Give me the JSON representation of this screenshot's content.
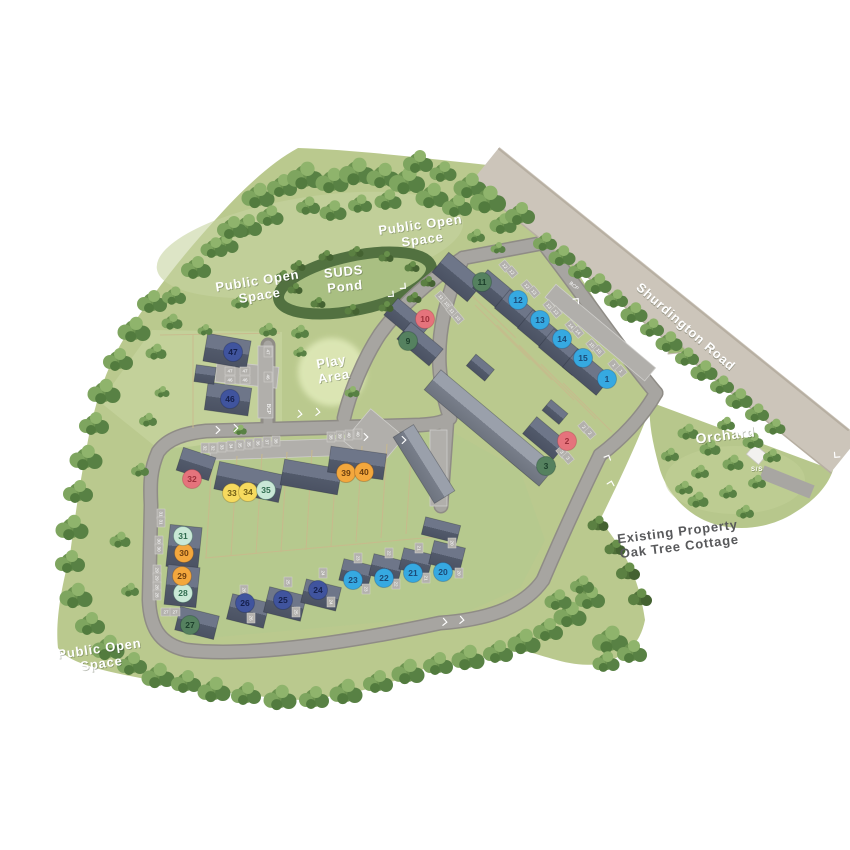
{
  "map": {
    "title": "Development site plan",
    "labels": [
      {
        "id": "public-open-space-top",
        "text": "Public Open\nSpace",
        "x": 421,
        "y": 229,
        "color": "#ffffff",
        "size": 13,
        "rotate": -8
      },
      {
        "id": "suds-pond",
        "text": "SUDS\nPond",
        "x": 344,
        "y": 276,
        "color": "#ffffff",
        "size": 13,
        "rotate": -6
      },
      {
        "id": "public-open-space-left",
        "text": "Public Open\nSpace",
        "x": 258,
        "y": 285,
        "color": "#ffffff",
        "size": 13,
        "rotate": -9
      },
      {
        "id": "play-area",
        "text": "Play\nArea",
        "x": 332,
        "y": 366,
        "color": "#ffffff",
        "size": 13,
        "rotate": -10
      },
      {
        "id": "public-open-space-bottom",
        "text": "Public Open\nSpace",
        "x": 100,
        "y": 653,
        "color": "#ffffff",
        "size": 13,
        "rotate": -8
      },
      {
        "id": "orchard",
        "text": "Orchard",
        "x": 726,
        "y": 440,
        "color": "#ffffff",
        "size": 14,
        "rotate": -7
      },
      {
        "id": "shurdington-road",
        "text": "Shurdington Road",
        "x": 683,
        "y": 330,
        "color": "#ffffff",
        "size": 13,
        "rotate": 41
      },
      {
        "id": "existing-property",
        "text": "Existing Property\nOak Tree Cottage",
        "x": 678,
        "y": 536,
        "color": "#58595b",
        "size": 13,
        "rotate": -7
      },
      {
        "id": "substation",
        "text": "S/S",
        "x": 757,
        "y": 471,
        "color": "#ffffff",
        "size": 6,
        "rotate": 0
      }
    ],
    "marker_styles": {
      "blue": {
        "fill": "#36a9e1",
        "text": "#1c4a77"
      },
      "navy": {
        "fill": "#40549e",
        "text": "#15204d"
      },
      "green": {
        "fill": "#55815f",
        "text": "#1c3f2b"
      },
      "pink": {
        "fill": "#e5737c",
        "text": "#9c2f3a"
      },
      "orange": {
        "fill": "#f3a73d",
        "text": "#6d3f10"
      },
      "yellow": {
        "fill": "#f6da5e",
        "text": "#6d5b14"
      },
      "mint": {
        "fill": "#c9e8d6",
        "text": "#2f6b4e"
      }
    },
    "markers": [
      {
        "plot": "1",
        "x": 607,
        "y": 379,
        "type": "blue"
      },
      {
        "plot": "2",
        "x": 567,
        "y": 441,
        "type": "pink"
      },
      {
        "plot": "3",
        "x": 546,
        "y": 466,
        "type": "green"
      },
      {
        "plot": "9",
        "x": 408,
        "y": 341,
        "type": "green"
      },
      {
        "plot": "10",
        "x": 425,
        "y": 319,
        "type": "pink"
      },
      {
        "plot": "11",
        "x": 482,
        "y": 282,
        "type": "green"
      },
      {
        "plot": "12",
        "x": 518,
        "y": 300,
        "type": "blue"
      },
      {
        "plot": "13",
        "x": 540,
        "y": 320,
        "type": "blue"
      },
      {
        "plot": "14",
        "x": 562,
        "y": 339,
        "type": "blue"
      },
      {
        "plot": "15",
        "x": 583,
        "y": 358,
        "type": "blue"
      },
      {
        "plot": "20",
        "x": 443,
        "y": 572,
        "type": "blue"
      },
      {
        "plot": "21",
        "x": 413,
        "y": 573,
        "type": "blue"
      },
      {
        "plot": "22",
        "x": 384,
        "y": 578,
        "type": "blue"
      },
      {
        "plot": "23",
        "x": 353,
        "y": 580,
        "type": "blue"
      },
      {
        "plot": "24",
        "x": 318,
        "y": 590,
        "type": "navy"
      },
      {
        "plot": "25",
        "x": 283,
        "y": 600,
        "type": "navy"
      },
      {
        "plot": "26",
        "x": 245,
        "y": 603,
        "type": "navy"
      },
      {
        "plot": "27",
        "x": 190,
        "y": 625,
        "type": "green"
      },
      {
        "plot": "28",
        "x": 183,
        "y": 593,
        "type": "mint"
      },
      {
        "plot": "29",
        "x": 182,
        "y": 576,
        "type": "orange"
      },
      {
        "plot": "30",
        "x": 184,
        "y": 553,
        "type": "orange"
      },
      {
        "plot": "31",
        "x": 183,
        "y": 536,
        "type": "mint"
      },
      {
        "plot": "32",
        "x": 192,
        "y": 479,
        "type": "pink"
      },
      {
        "plot": "33",
        "x": 232,
        "y": 493,
        "type": "yellow"
      },
      {
        "plot": "34",
        "x": 248,
        "y": 492,
        "type": "yellow"
      },
      {
        "plot": "35",
        "x": 266,
        "y": 490,
        "type": "mint"
      },
      {
        "plot": "39",
        "x": 346,
        "y": 473,
        "type": "orange"
      },
      {
        "plot": "40",
        "x": 364,
        "y": 472,
        "type": "orange"
      },
      {
        "plot": "46",
        "x": 230,
        "y": 399,
        "type": "navy"
      },
      {
        "plot": "47",
        "x": 233,
        "y": 352,
        "type": "navy"
      }
    ],
    "road_markings": {
      "v_arrows": [
        [
          392,
          295,
          130
        ],
        [
          404,
          287,
          130
        ],
        [
          300,
          414,
          95
        ],
        [
          318,
          412,
          95
        ],
        [
          366,
          437,
          90
        ],
        [
          404,
          440,
          90
        ],
        [
          577,
          300,
          40
        ],
        [
          608,
          457,
          25
        ],
        [
          611,
          483,
          15
        ],
        [
          836,
          456,
          220
        ],
        [
          218,
          430,
          90
        ],
        [
          236,
          428,
          90
        ],
        [
          445,
          622,
          95
        ],
        [
          462,
          620,
          95
        ]
      ],
      "bcp_labels": [
        [
          573,
          287,
          40
        ],
        [
          267,
          409,
          90
        ]
      ],
      "bcp_text": "BCP"
    },
    "bay_labels": [
      [
        505,
        266,
        "12",
        50
      ],
      [
        512,
        272,
        "12",
        50
      ],
      [
        527,
        286,
        "12",
        50
      ],
      [
        534,
        292,
        "13",
        50
      ],
      [
        549,
        306,
        "13",
        50
      ],
      [
        556,
        312,
        "13",
        50
      ],
      [
        571,
        326,
        "14",
        50
      ],
      [
        578,
        332,
        "14",
        50
      ],
      [
        592,
        345,
        "15",
        50
      ],
      [
        599,
        351,
        "15",
        50
      ],
      [
        614,
        365,
        "1",
        50
      ],
      [
        621,
        371,
        "1",
        50
      ],
      [
        441,
        297,
        "11",
        50
      ],
      [
        447,
        304,
        "10",
        50
      ],
      [
        452,
        311,
        "11",
        50
      ],
      [
        458,
        318,
        "10",
        50
      ],
      [
        584,
        427,
        "2",
        50
      ],
      [
        590,
        433,
        "2",
        50
      ],
      [
        562,
        452,
        "3",
        50
      ],
      [
        568,
        458,
        "3",
        50
      ],
      [
        222,
        447,
        "33",
        90
      ],
      [
        231,
        446,
        "34",
        90
      ],
      [
        240,
        445,
        "35",
        90
      ],
      [
        249,
        444,
        "35",
        90
      ],
      [
        258,
        443,
        "36",
        90
      ],
      [
        267,
        442,
        "37",
        90
      ],
      [
        276,
        441,
        "38",
        90
      ],
      [
        331,
        437,
        "38",
        90
      ],
      [
        340,
        436,
        "39",
        90
      ],
      [
        349,
        435,
        "40",
        90
      ],
      [
        358,
        434,
        "40",
        90
      ],
      [
        161,
        514,
        "31",
        90
      ],
      [
        161,
        522,
        "31",
        90
      ],
      [
        159,
        541,
        "30",
        90
      ],
      [
        159,
        549,
        "30",
        90
      ],
      [
        157,
        570,
        "29",
        90
      ],
      [
        157,
        578,
        "29",
        90
      ],
      [
        157,
        587,
        "28",
        90
      ],
      [
        157,
        595,
        "28",
        90
      ],
      [
        166,
        612,
        "27",
        0
      ],
      [
        175,
        612,
        "27",
        0
      ],
      [
        244,
        590,
        "26",
        90
      ],
      [
        251,
        618,
        "26",
        90
      ],
      [
        288,
        582,
        "25",
        90
      ],
      [
        296,
        612,
        "25",
        90
      ],
      [
        323,
        573,
        "24",
        90
      ],
      [
        331,
        602,
        "24",
        90
      ],
      [
        358,
        558,
        "23",
        90
      ],
      [
        366,
        589,
        "23",
        90
      ],
      [
        389,
        553,
        "22",
        90
      ],
      [
        396,
        584,
        "22",
        90
      ],
      [
        419,
        548,
        "21",
        90
      ],
      [
        426,
        578,
        "21",
        90
      ],
      [
        452,
        543,
        "20",
        90
      ],
      [
        459,
        573,
        "20",
        90
      ],
      [
        205,
        448,
        "32",
        90
      ],
      [
        213,
        448,
        "32",
        90
      ],
      [
        230,
        371,
        "47",
        0
      ],
      [
        245,
        371,
        "47",
        0
      ],
      [
        230,
        380,
        "46",
        0
      ],
      [
        245,
        380,
        "46",
        0
      ],
      [
        268,
        352,
        "47",
        90
      ],
      [
        268,
        377,
        "46",
        90
      ]
    ]
  }
}
